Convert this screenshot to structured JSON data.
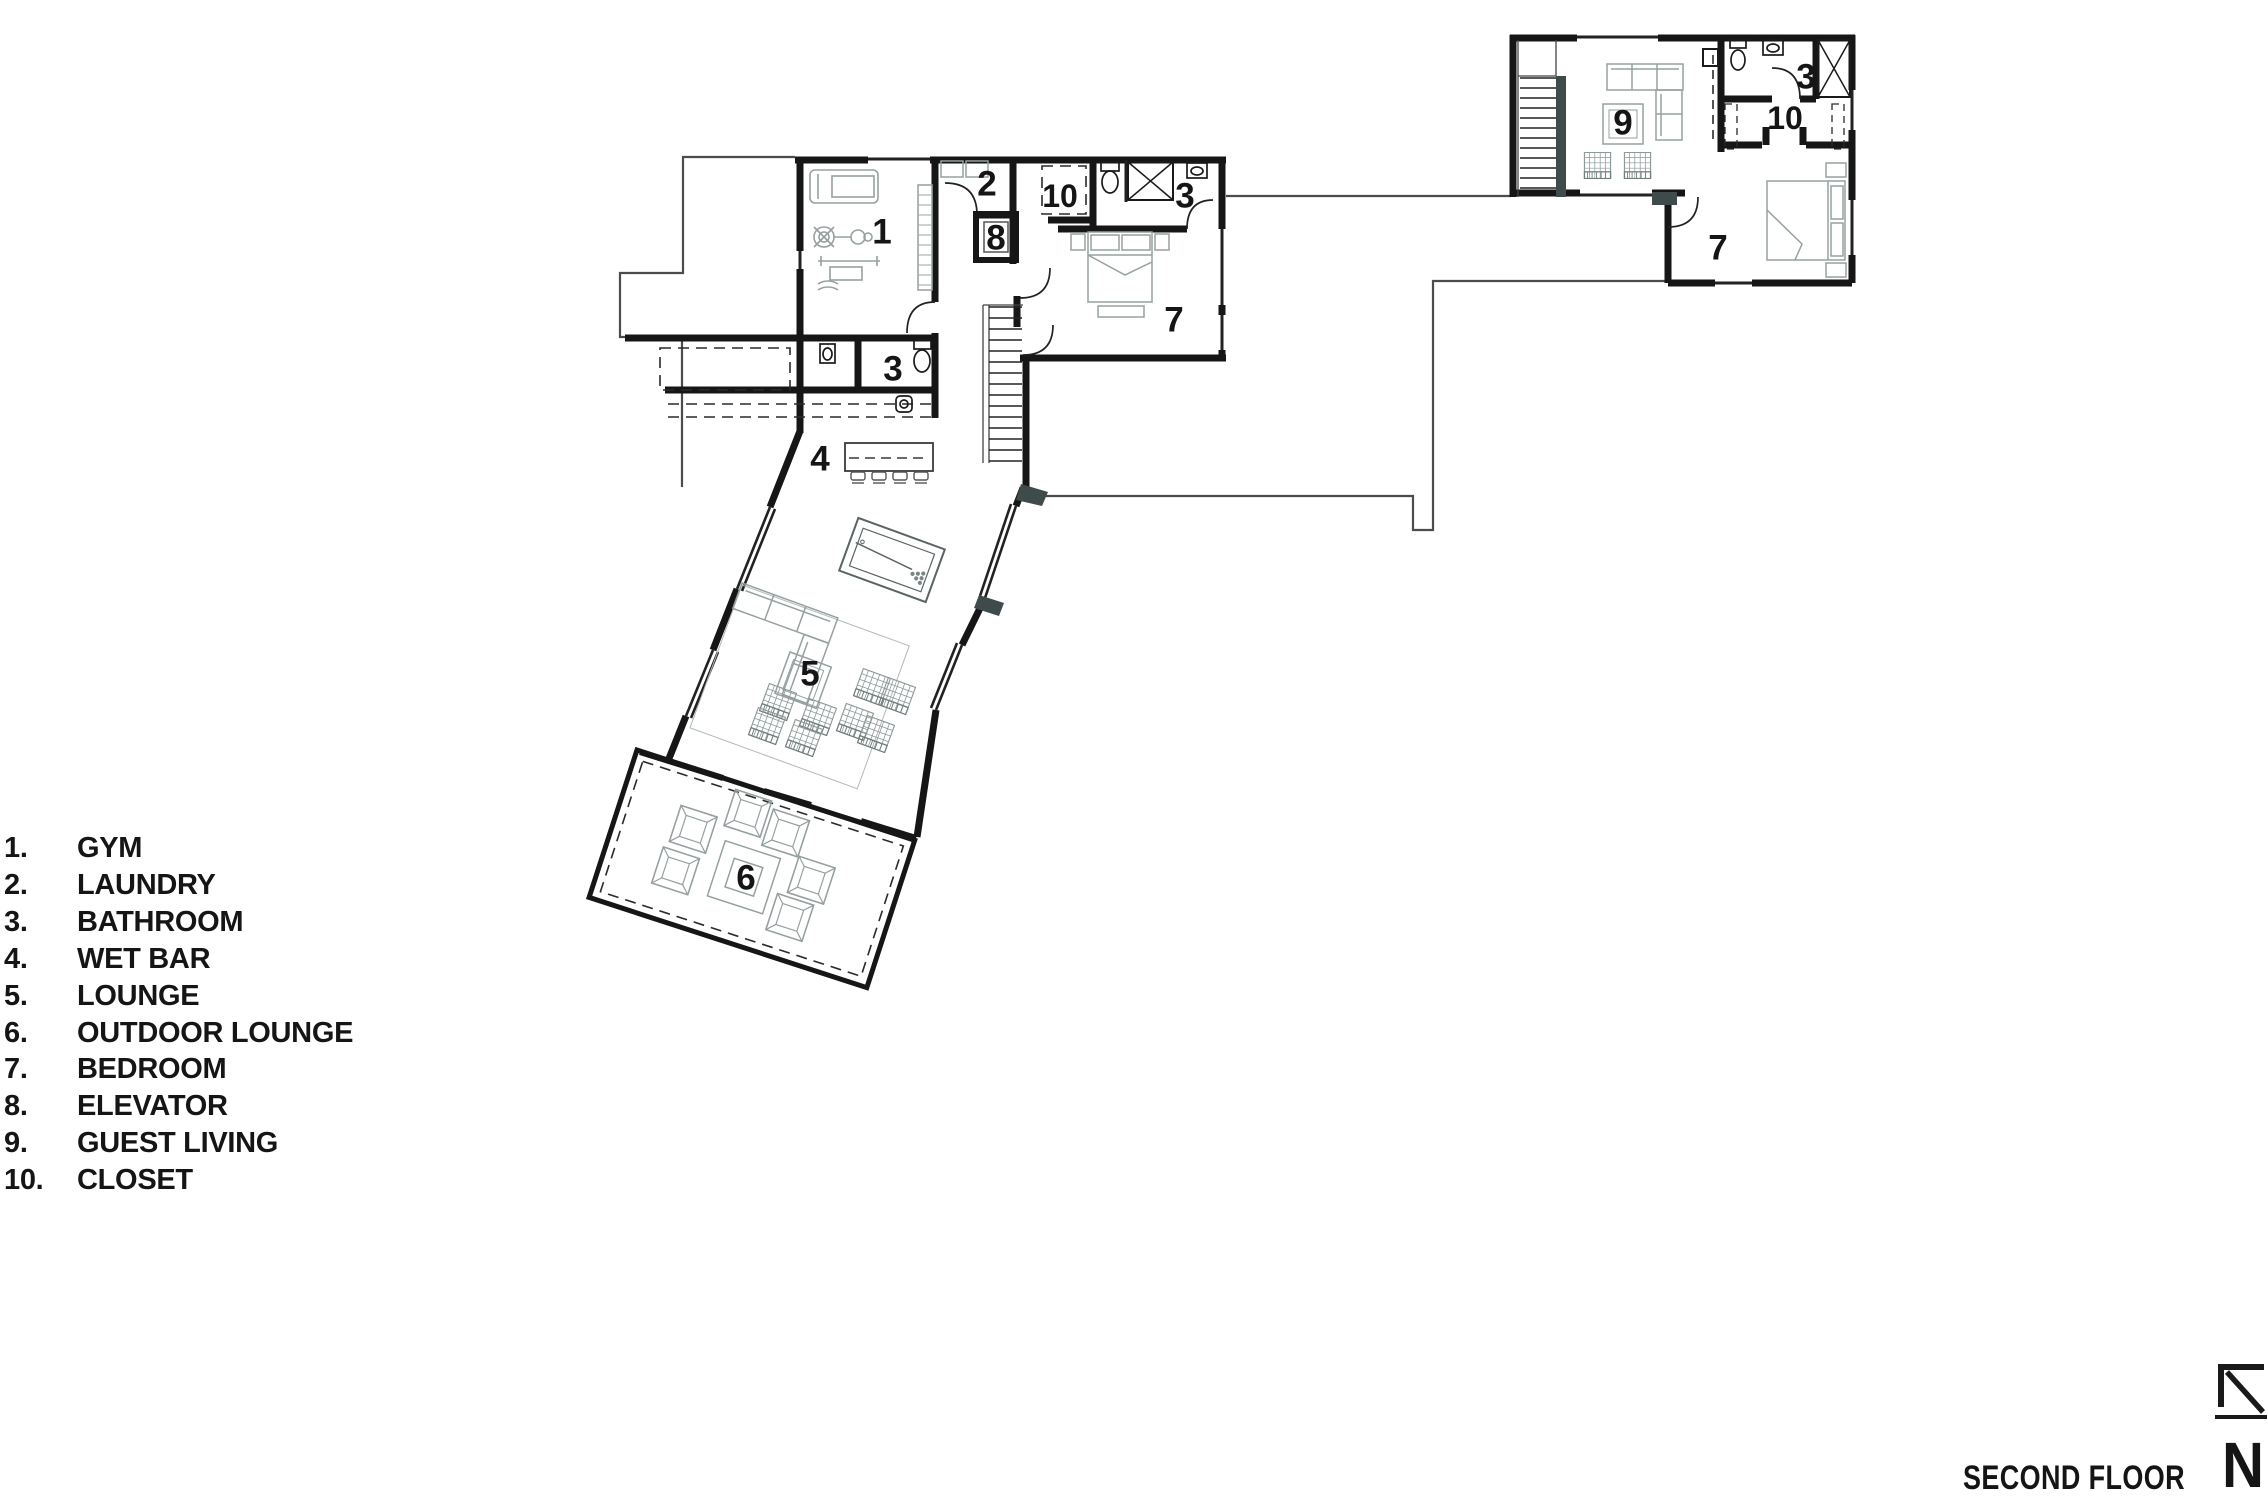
{
  "title": "SECOND FLOOR",
  "north": {
    "label": "N"
  },
  "legend": {
    "items": [
      {
        "num": "1.",
        "label": "GYM"
      },
      {
        "num": "2.",
        "label": "LAUNDRY"
      },
      {
        "num": "3.",
        "label": "BATHROOM"
      },
      {
        "num": "4.",
        "label": "WET BAR"
      },
      {
        "num": "5.",
        "label": "LOUNGE"
      },
      {
        "num": "6.",
        "label": "OUTDOOR LOUNGE"
      },
      {
        "num": "7.",
        "label": "BEDROOM"
      },
      {
        "num": "8.",
        "label": "ELEVATOR"
      },
      {
        "num": "9.",
        "label": "GUEST LIVING"
      },
      {
        "num": "10.",
        "label": "CLOSET"
      }
    ]
  },
  "plan": {
    "room_labels": [
      {
        "room": "gym",
        "text": "1"
      },
      {
        "room": "laundry",
        "text": "2"
      },
      {
        "room": "elevator",
        "text": "8"
      },
      {
        "room": "closet-main",
        "text": "10"
      },
      {
        "room": "bathroom-main",
        "text": "3"
      },
      {
        "room": "bedroom-main",
        "text": "7"
      },
      {
        "room": "bathroom-lower",
        "text": "3"
      },
      {
        "room": "wet-bar",
        "text": "4"
      },
      {
        "room": "lounge",
        "text": "5"
      },
      {
        "room": "outdoor-lounge",
        "text": "6"
      },
      {
        "room": "guest-living",
        "text": "9"
      },
      {
        "room": "closet-guest",
        "text": "10"
      },
      {
        "room": "bathroom-guest",
        "text": "3"
      },
      {
        "room": "bedroom-guest",
        "text": "7"
      }
    ]
  },
  "colors": {
    "wall": "#161616",
    "furniture": "#96a0a0",
    "stair_fill": "#3f4a4a",
    "roofline": "#4c4c4c",
    "text": "#151515"
  }
}
